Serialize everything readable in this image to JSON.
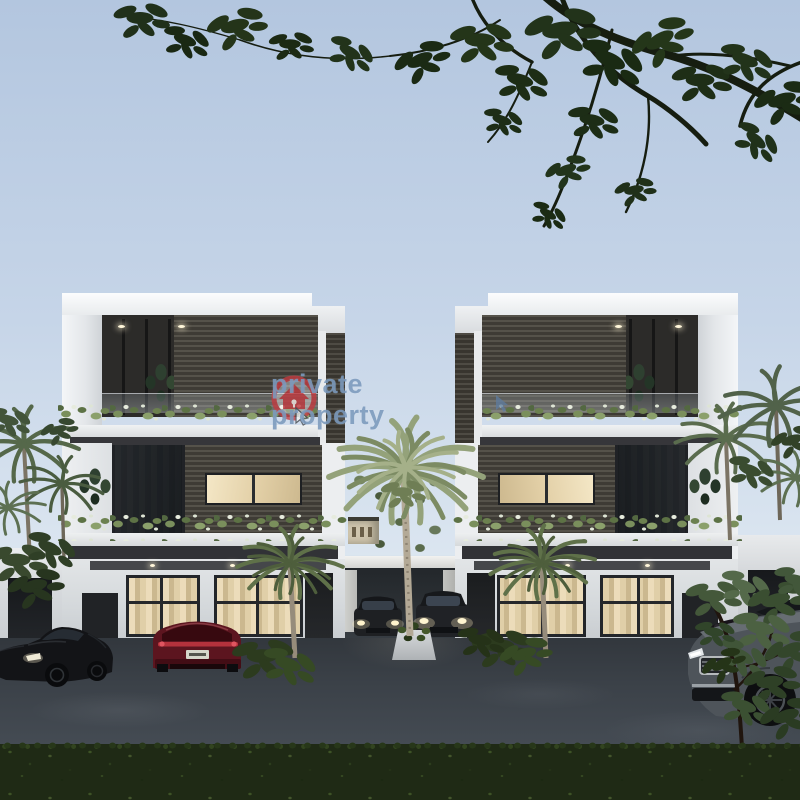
{
  "meta": {
    "type": "architectural-render-photo",
    "description": "Dusk 3D render of two mirrored modern three-storey white duplex houses with dark timber-slat cladding, planted balcony edges, palm trees, a central gated driveway with parked cars, luxury cars on the street and a hedge in the foreground, framed by overhanging tree branches."
  },
  "watermark": {
    "text": "private property",
    "logo": "private-property-house-cursor-logo",
    "logo_ring_color": "#c23a40",
    "text_color": "#7a98bc"
  },
  "scene": {
    "sky": {
      "top": "#b3c6df",
      "bottom": "#e9eef4"
    },
    "buildings": [
      {
        "id": "left-house",
        "floors": 3,
        "style": "modern white cube, dark slat panels, glass balustrades, planted balcony planters, warm interior lighting"
      },
      {
        "id": "right-house",
        "floors": 3,
        "style": "mirror image of left house"
      },
      {
        "id": "distant-building",
        "color": "#cfc5ad",
        "position": "center background"
      }
    ],
    "vehicles": [
      {
        "id": "black-sports-car",
        "color": "#131417",
        "position": "bottom-left street"
      },
      {
        "id": "maroon-coupe",
        "color": "#5c151f",
        "position": "parked before left house"
      },
      {
        "id": "driveway-car-left",
        "color": "#1e2023",
        "position": "central driveway, headlights on"
      },
      {
        "id": "driveway-car-right",
        "color": "#202226",
        "position": "central driveway, headlights on"
      },
      {
        "id": "grey-sedan",
        "color": "#4e545a",
        "position": "bottom-right street"
      },
      {
        "id": "dark-car-behind-sedan",
        "color": "#18141a",
        "position": "right, behind sedan"
      }
    ],
    "vegetation": [
      "overhanging-branches-top",
      "left-palm-cluster",
      "right-palm-cluster",
      "center-tall-palm",
      "house-front-palms",
      "balcony-trailing-planters",
      "driveway-island-shrub",
      "corner-tree-right",
      "foreground-hedge-row"
    ],
    "road_color": "#3a4047",
    "hedge_color": "#1f2a15"
  }
}
